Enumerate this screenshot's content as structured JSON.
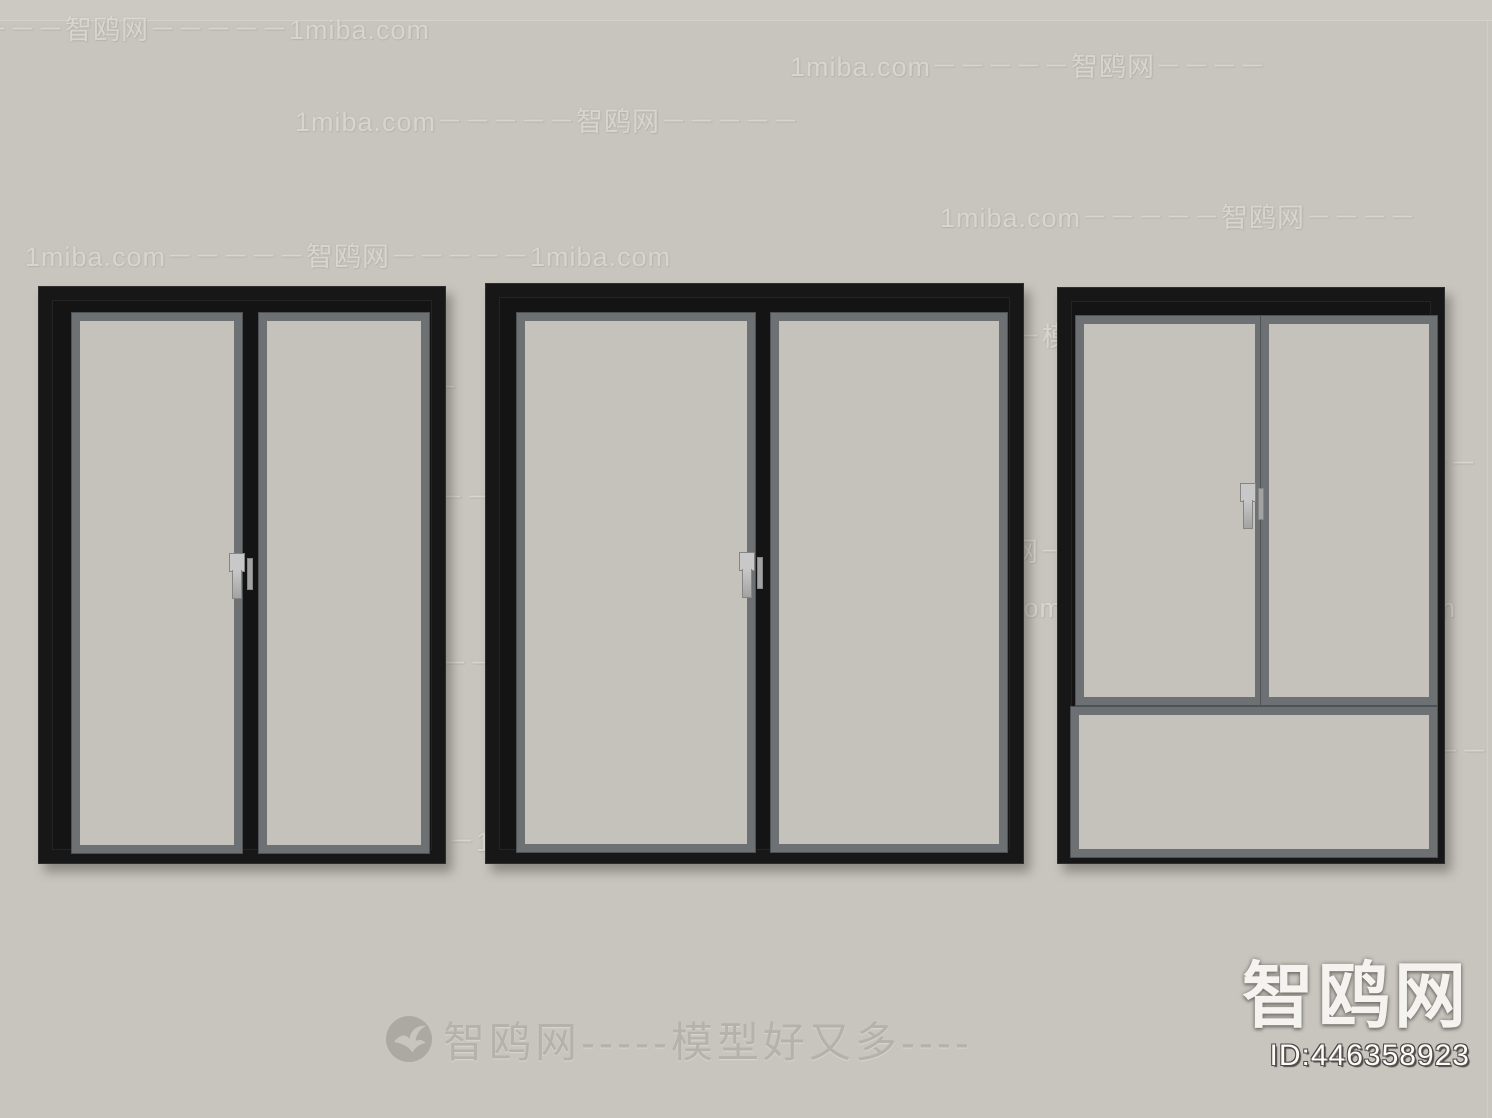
{
  "colors": {
    "bg": "#c8c5be",
    "bgTop": "#ccc9c2",
    "seam": "#d8d5ce",
    "glass": "#c5c2bc",
    "trim": "#6d7173",
    "trimEdge": "#4d5254",
    "frame": "#171717",
    "frameHi": "#2e2e2e",
    "mullion": "#141414",
    "shadow": "rgba(55,52,48,0.40)",
    "wmText": "#e6e3dc",
    "wmShadow": "rgba(140,137,130,0.45)",
    "footerText": "#b3b0a9",
    "logoBg": "#a9a6a0",
    "logoBird": "#c9c6bf",
    "badgeText": "#f4f3f0",
    "badgeShadow": "rgba(110,107,102,0.85)",
    "idText": "#fcfbf9",
    "idOutline": "#4a4844",
    "handleLight": "#c8c8c8",
    "handleMid": "#a3a3a3",
    "handleDark": "#858585"
  },
  "watermark": {
    "items": [
      {
        "x": -75,
        "y": 8,
        "text": "－－－－－智鸥网－－－－－1miba.com"
      },
      {
        "x": 790,
        "y": 45,
        "text": "1miba.com－－－－－智鸥网－－－－"
      },
      {
        "x": 295,
        "y": 100,
        "text": "1miba.com－－－－－智鸥网－－－－－"
      },
      {
        "x": 940,
        "y": 196,
        "text": "1miba.com－－－－－智鸥网－－－－"
      },
      {
        "x": 25,
        "y": 235,
        "text": "1miba.com－－－－－智鸥网－－－－－1miba.com"
      },
      {
        "x": 818,
        "y": 315,
        "text": "－－智鸥网－－－模型好又多－－－－－"
      },
      {
        "x": 66,
        "y": 366,
        "text": "智鸥网－－－1miba.com－－－"
      },
      {
        "x": 1338,
        "y": 442,
        "text": "智鸥网－－"
      },
      {
        "x": 128,
        "y": 476,
        "text": "1miba.com－－－智鸥网－－－－－"
      },
      {
        "x": 843,
        "y": 530,
        "text": "－－－－智鸥网－－－－－"
      },
      {
        "x": 922,
        "y": 586,
        "text": "1miba.com－－－智鸥网－－－1miba.com"
      },
      {
        "x": 132,
        "y": 642,
        "text": "智鸥网－－1miba.com－－－－"
      },
      {
        "x": 1068,
        "y": 730,
        "text": "1miba.com－－－－智鸥网－－－"
      },
      {
        "x": 140,
        "y": 820,
        "text": "－－－－－智鸥网－－－－1miba.com－－－"
      }
    ]
  },
  "footer": {
    "logo_icon": "seagull-icon",
    "tagline": "智鸥网-----模型好又多----"
  },
  "badge": {
    "site": "智鸥网",
    "id": "ID:446358923"
  }
}
